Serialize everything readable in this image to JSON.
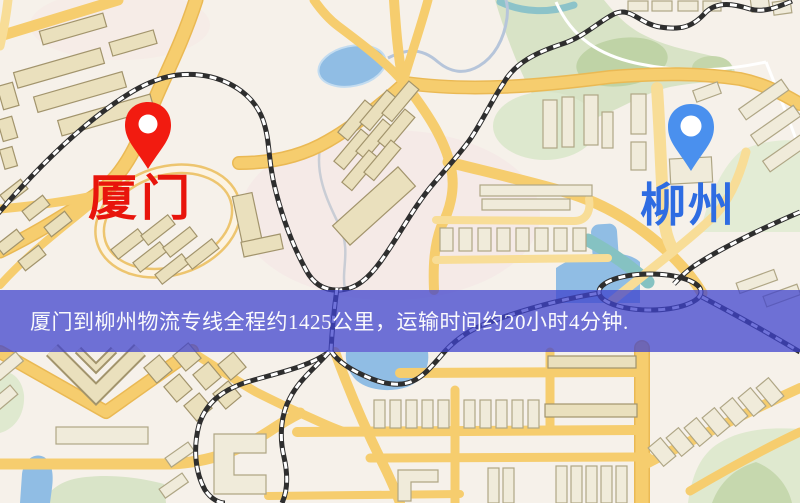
{
  "map": {
    "pins": [
      {
        "id": "origin",
        "city": "厦门",
        "pin_color": "#f21b10",
        "label_color": "#e8150c"
      },
      {
        "id": "destination",
        "city": "柳州",
        "pin_color": "#4a90ee",
        "label_color": "#2e6ce2"
      }
    ]
  },
  "banner": {
    "text": "厦门到柳州物流专线全程约1425公里，运输时间约20小时4分钟.",
    "bg_color": "rgba(62,66,205,0.74)",
    "text_color": "#fafafc"
  }
}
